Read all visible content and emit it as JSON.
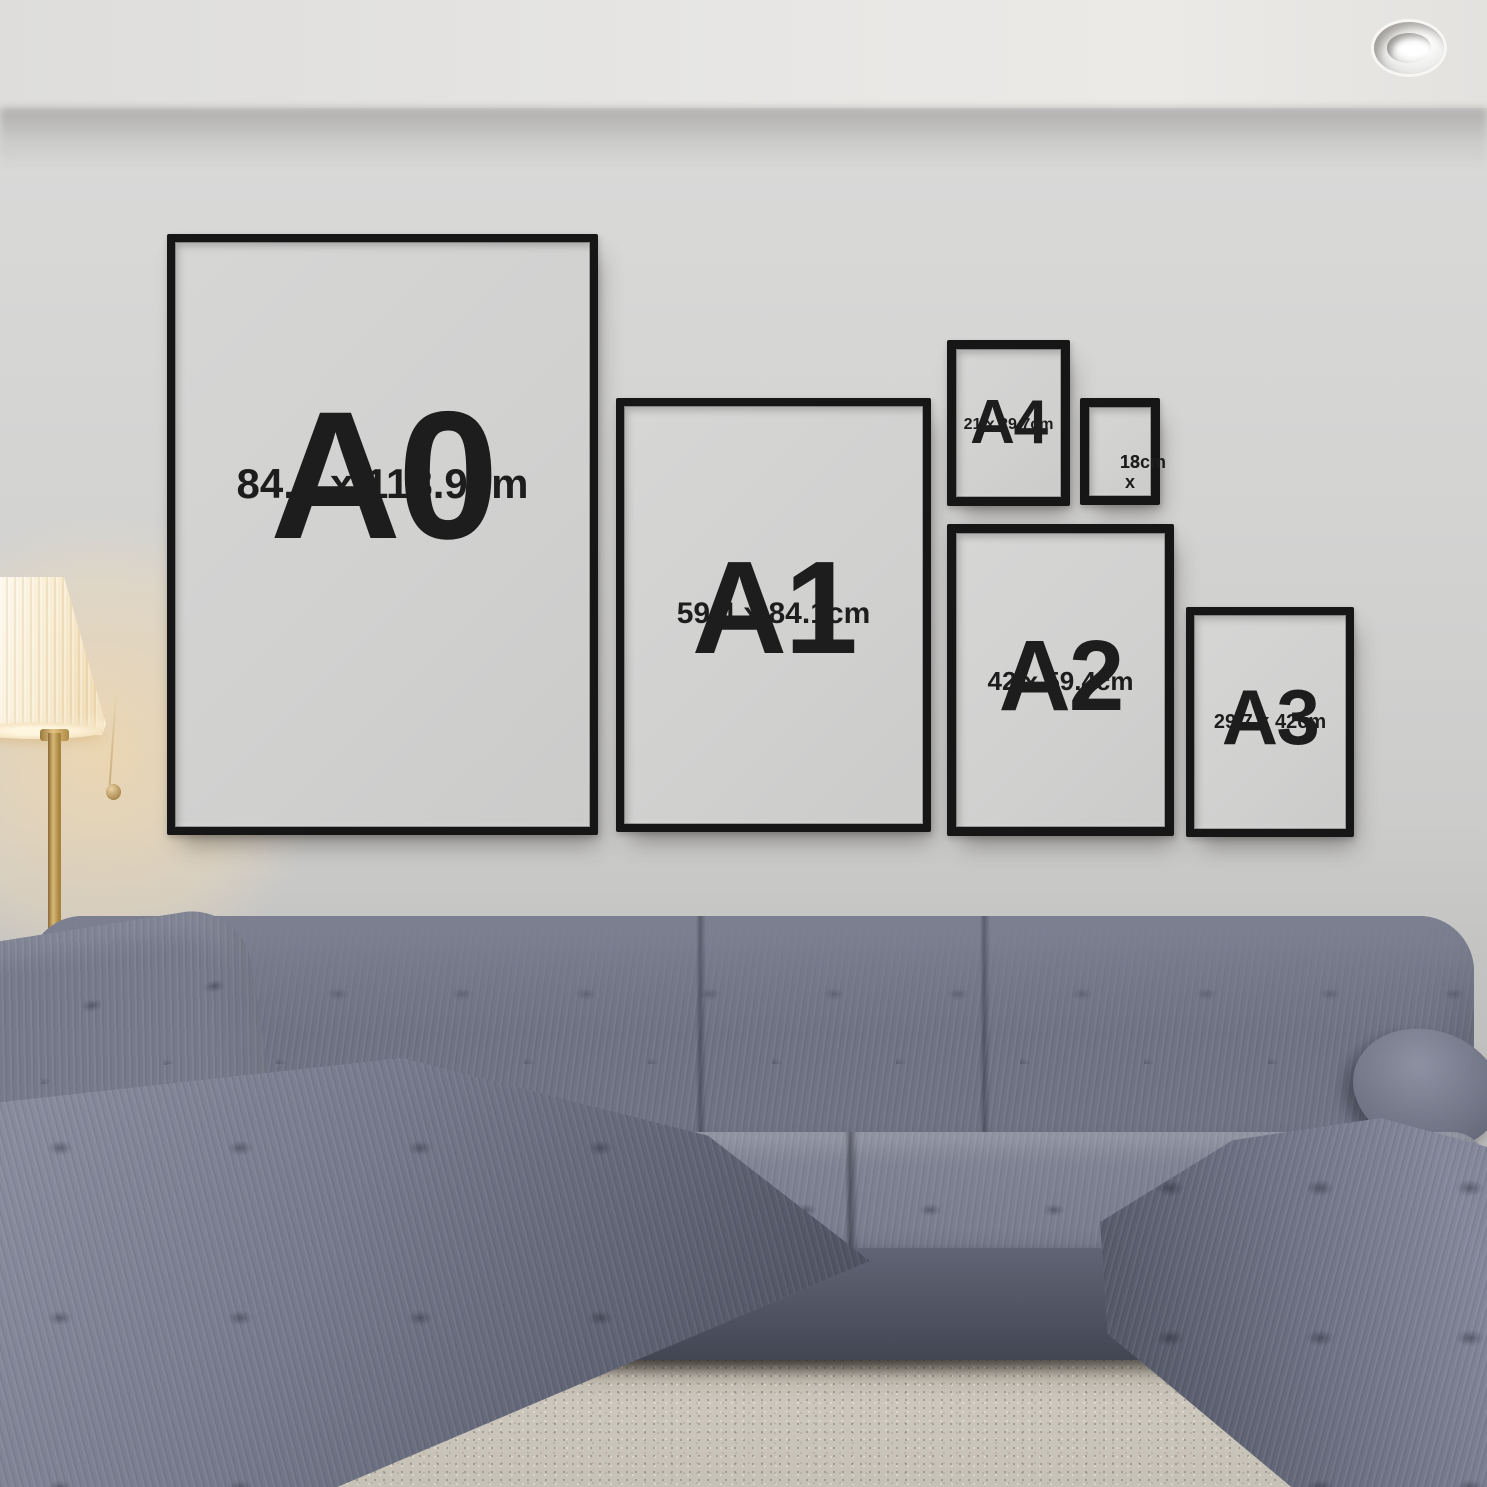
{
  "frames": {
    "a0": {
      "label": "A0",
      "dimensions": "84.1 x 118.9cm"
    },
    "a1": {
      "label": "A1",
      "dimensions": "59.4 x 84.1cm"
    },
    "a4": {
      "label": "A4",
      "dimensions": "21 x 29.7cm"
    },
    "photo13x18": {
      "line1": "13 x",
      "line2": "18cm"
    },
    "a2": {
      "label": "A2",
      "dimensions": "42 x 59.4cm"
    },
    "a3": {
      "label": "A3",
      "dimensions": "29.7 x 42cm"
    }
  },
  "colors": {
    "frame_black": "#161616",
    "frame_mat": "#d2d2d1",
    "label_text": "#1d1d1d",
    "wall": "#d3d3d2",
    "ceiling": "#e8e7e5",
    "sofa_fabric": "#6f7384",
    "rug": "#c6c1b6",
    "floor_wood": "#30211a",
    "lamp_shade": "#f9edd2",
    "lamp_brass": "#b08a45",
    "lamp_glow": "#ffdba0"
  }
}
